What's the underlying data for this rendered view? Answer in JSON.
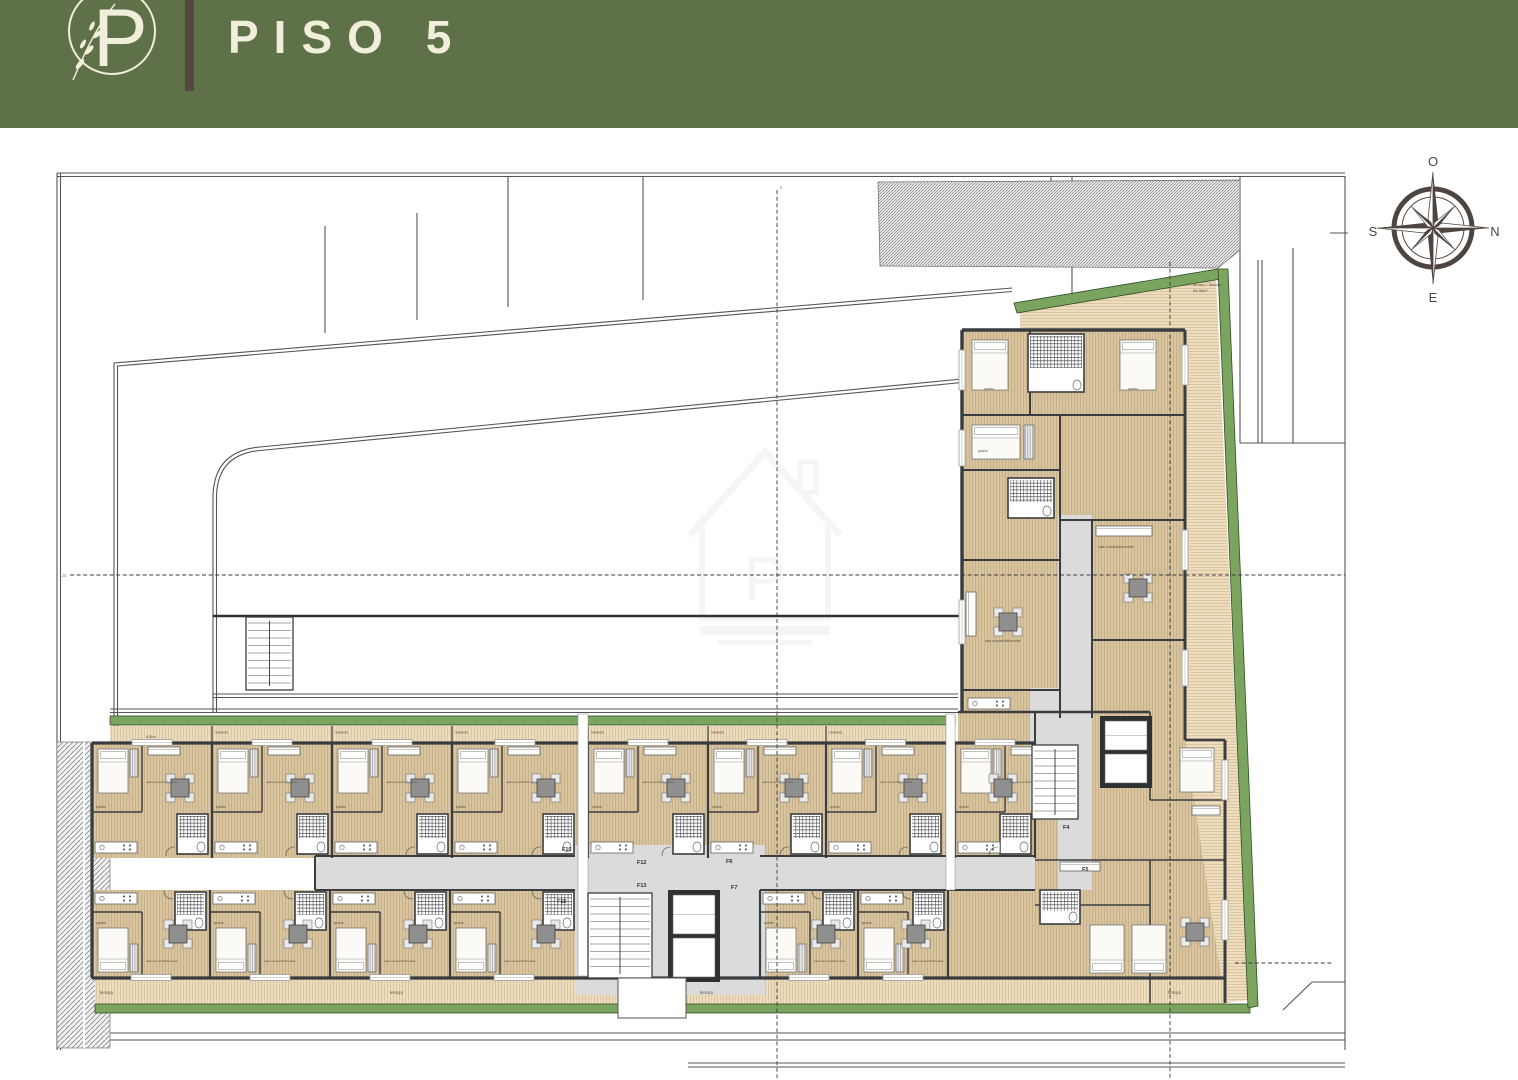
{
  "header": {
    "title": "PISO 5",
    "logo_letter": "P"
  },
  "compass": {
    "top": "O",
    "right": "N",
    "bottom": "E",
    "left": "S"
  },
  "colors": {
    "header_green": "#5F7149",
    "cream": "#F2EEDC",
    "divider_brown": "#574744",
    "wall": "#3A3D40",
    "wall_dark": "#2F3133",
    "room_tan": "#D9C4A0",
    "terrace_tan": "#EDDCBE",
    "green_strip": "#7BA45F",
    "green_dark": "#2F4D27",
    "corridor_gray": "#DBDBDB",
    "line_gray": "#555555",
    "compass_ink": "#4E4540"
  },
  "plan": {
    "site": {
      "solid_lines": [
        [
          57,
          173,
          1345,
          173
        ],
        [
          57,
          176.5,
          1345,
          176.5
        ],
        [
          57,
          173,
          57,
          1050
        ],
        [
          60.5,
          173,
          60.5,
          1050
        ],
        [
          1345,
          176,
          1345,
          1050
        ],
        [
          643,
          177,
          643,
          300
        ],
        [
          1051,
          177,
          1051,
          256
        ],
        [
          1072,
          177,
          1072,
          443
        ],
        [
          1240,
          177,
          1240,
          443
        ],
        [
          1258,
          260,
          1258,
          443
        ],
        [
          1262,
          260,
          1262,
          443
        ],
        [
          1293,
          248,
          1293,
          443
        ],
        [
          1240,
          443,
          1345,
          443
        ],
        [
          325,
          226,
          325,
          333
        ],
        [
          417,
          213,
          417,
          320
        ],
        [
          508,
          177,
          508,
          307
        ],
        [
          1330,
          233,
          1348,
          233
        ],
        [
          85,
          1033,
          1345,
          1033
        ],
        [
          85,
          1040,
          1345,
          1040
        ],
        [
          688,
          1063,
          1345,
          1063
        ],
        [
          688,
          1067,
          1345,
          1067
        ],
        [
          1283,
          1010,
          1312,
          982
        ],
        [
          1312,
          982,
          1345,
          982
        ]
      ],
      "dashed_lines": [
        [
          777,
          190,
          777,
          1078
        ],
        [
          70,
          575,
          1345,
          575
        ],
        [
          1170,
          262,
          1170,
          1078
        ],
        [
          1235,
          963,
          1332,
          963
        ]
      ],
      "hatch_topright": [
        [
          878,
          182
        ],
        [
          1240,
          180
        ],
        [
          1240,
          250
        ],
        [
          1218,
          268
        ],
        [
          880,
          266
        ]
      ],
      "hatch_left": [
        57,
        742,
        53,
        306
      ]
    },
    "bottom_wing": {
      "upper_units": [
        {
          "x": 92,
          "w": 120
        },
        {
          "x": 212,
          "w": 120
        },
        {
          "x": 332,
          "w": 120
        },
        {
          "x": 452,
          "w": 126
        },
        {
          "x": 588,
          "w": 120
        },
        {
          "x": 708,
          "w": 118
        },
        {
          "x": 826,
          "w": 119
        },
        {
          "x": 955,
          "w": 80
        }
      ],
      "lower_units": [
        {
          "x": 92,
          "w": 118
        },
        {
          "x": 210,
          "w": 120
        },
        {
          "x": 330,
          "w": 120
        },
        {
          "x": 450,
          "w": 128
        },
        {
          "x": 760,
          "w": 98
        },
        {
          "x": 858,
          "w": 90
        }
      ]
    },
    "labels": {
      "bedroom": "quarto",
      "living": "sala comum/kitchenette",
      "balcony": "varanda",
      "terrace": "terraço",
      "terrace_planter_line1": "terraço / floreira",
      "terrace_planter_line2": "84,36m²",
      "balcony_area": "6,00m²",
      "f_units": [
        {
          "t": "F4",
          "x": 1063,
          "y": 829
        },
        {
          "t": "F5",
          "x": 1082,
          "y": 871
        },
        {
          "t": "F6",
          "x": 726,
          "y": 863
        },
        {
          "t": "F7",
          "x": 731,
          "y": 889
        },
        {
          "t": "F10",
          "x": 562,
          "y": 851
        },
        {
          "t": "F12",
          "x": 637,
          "y": 864
        },
        {
          "t": "F13",
          "x": 637,
          "y": 887
        },
        {
          "t": "F15",
          "x": 557,
          "y": 903
        }
      ],
      "terrace_positions": [
        [
          100,
          994
        ],
        [
          390,
          994
        ],
        [
          700,
          994
        ],
        [
          1168,
          994
        ]
      ],
      "right_wing_rooms": [
        {
          "t": "quarto",
          "x": 984,
          "y": 390
        },
        {
          "t": "quarto",
          "x": 1128,
          "y": 390
        },
        {
          "t": "quarto",
          "x": 978,
          "y": 452
        },
        {
          "t": "sala comum/kitchenette",
          "x": 1098,
          "y": 548
        },
        {
          "t": "sala comum/kitchenette",
          "x": 985,
          "y": 642
        }
      ],
      "area_marks": [
        {
          "t": "6,00m²",
          "x": 146,
          "y": 738
        }
      ],
      "tiny_marks": [
        {
          "t": "25",
          "x": 62,
          "y": 577
        },
        {
          "t": "5",
          "x": 780,
          "y": 189
        }
      ]
    }
  }
}
